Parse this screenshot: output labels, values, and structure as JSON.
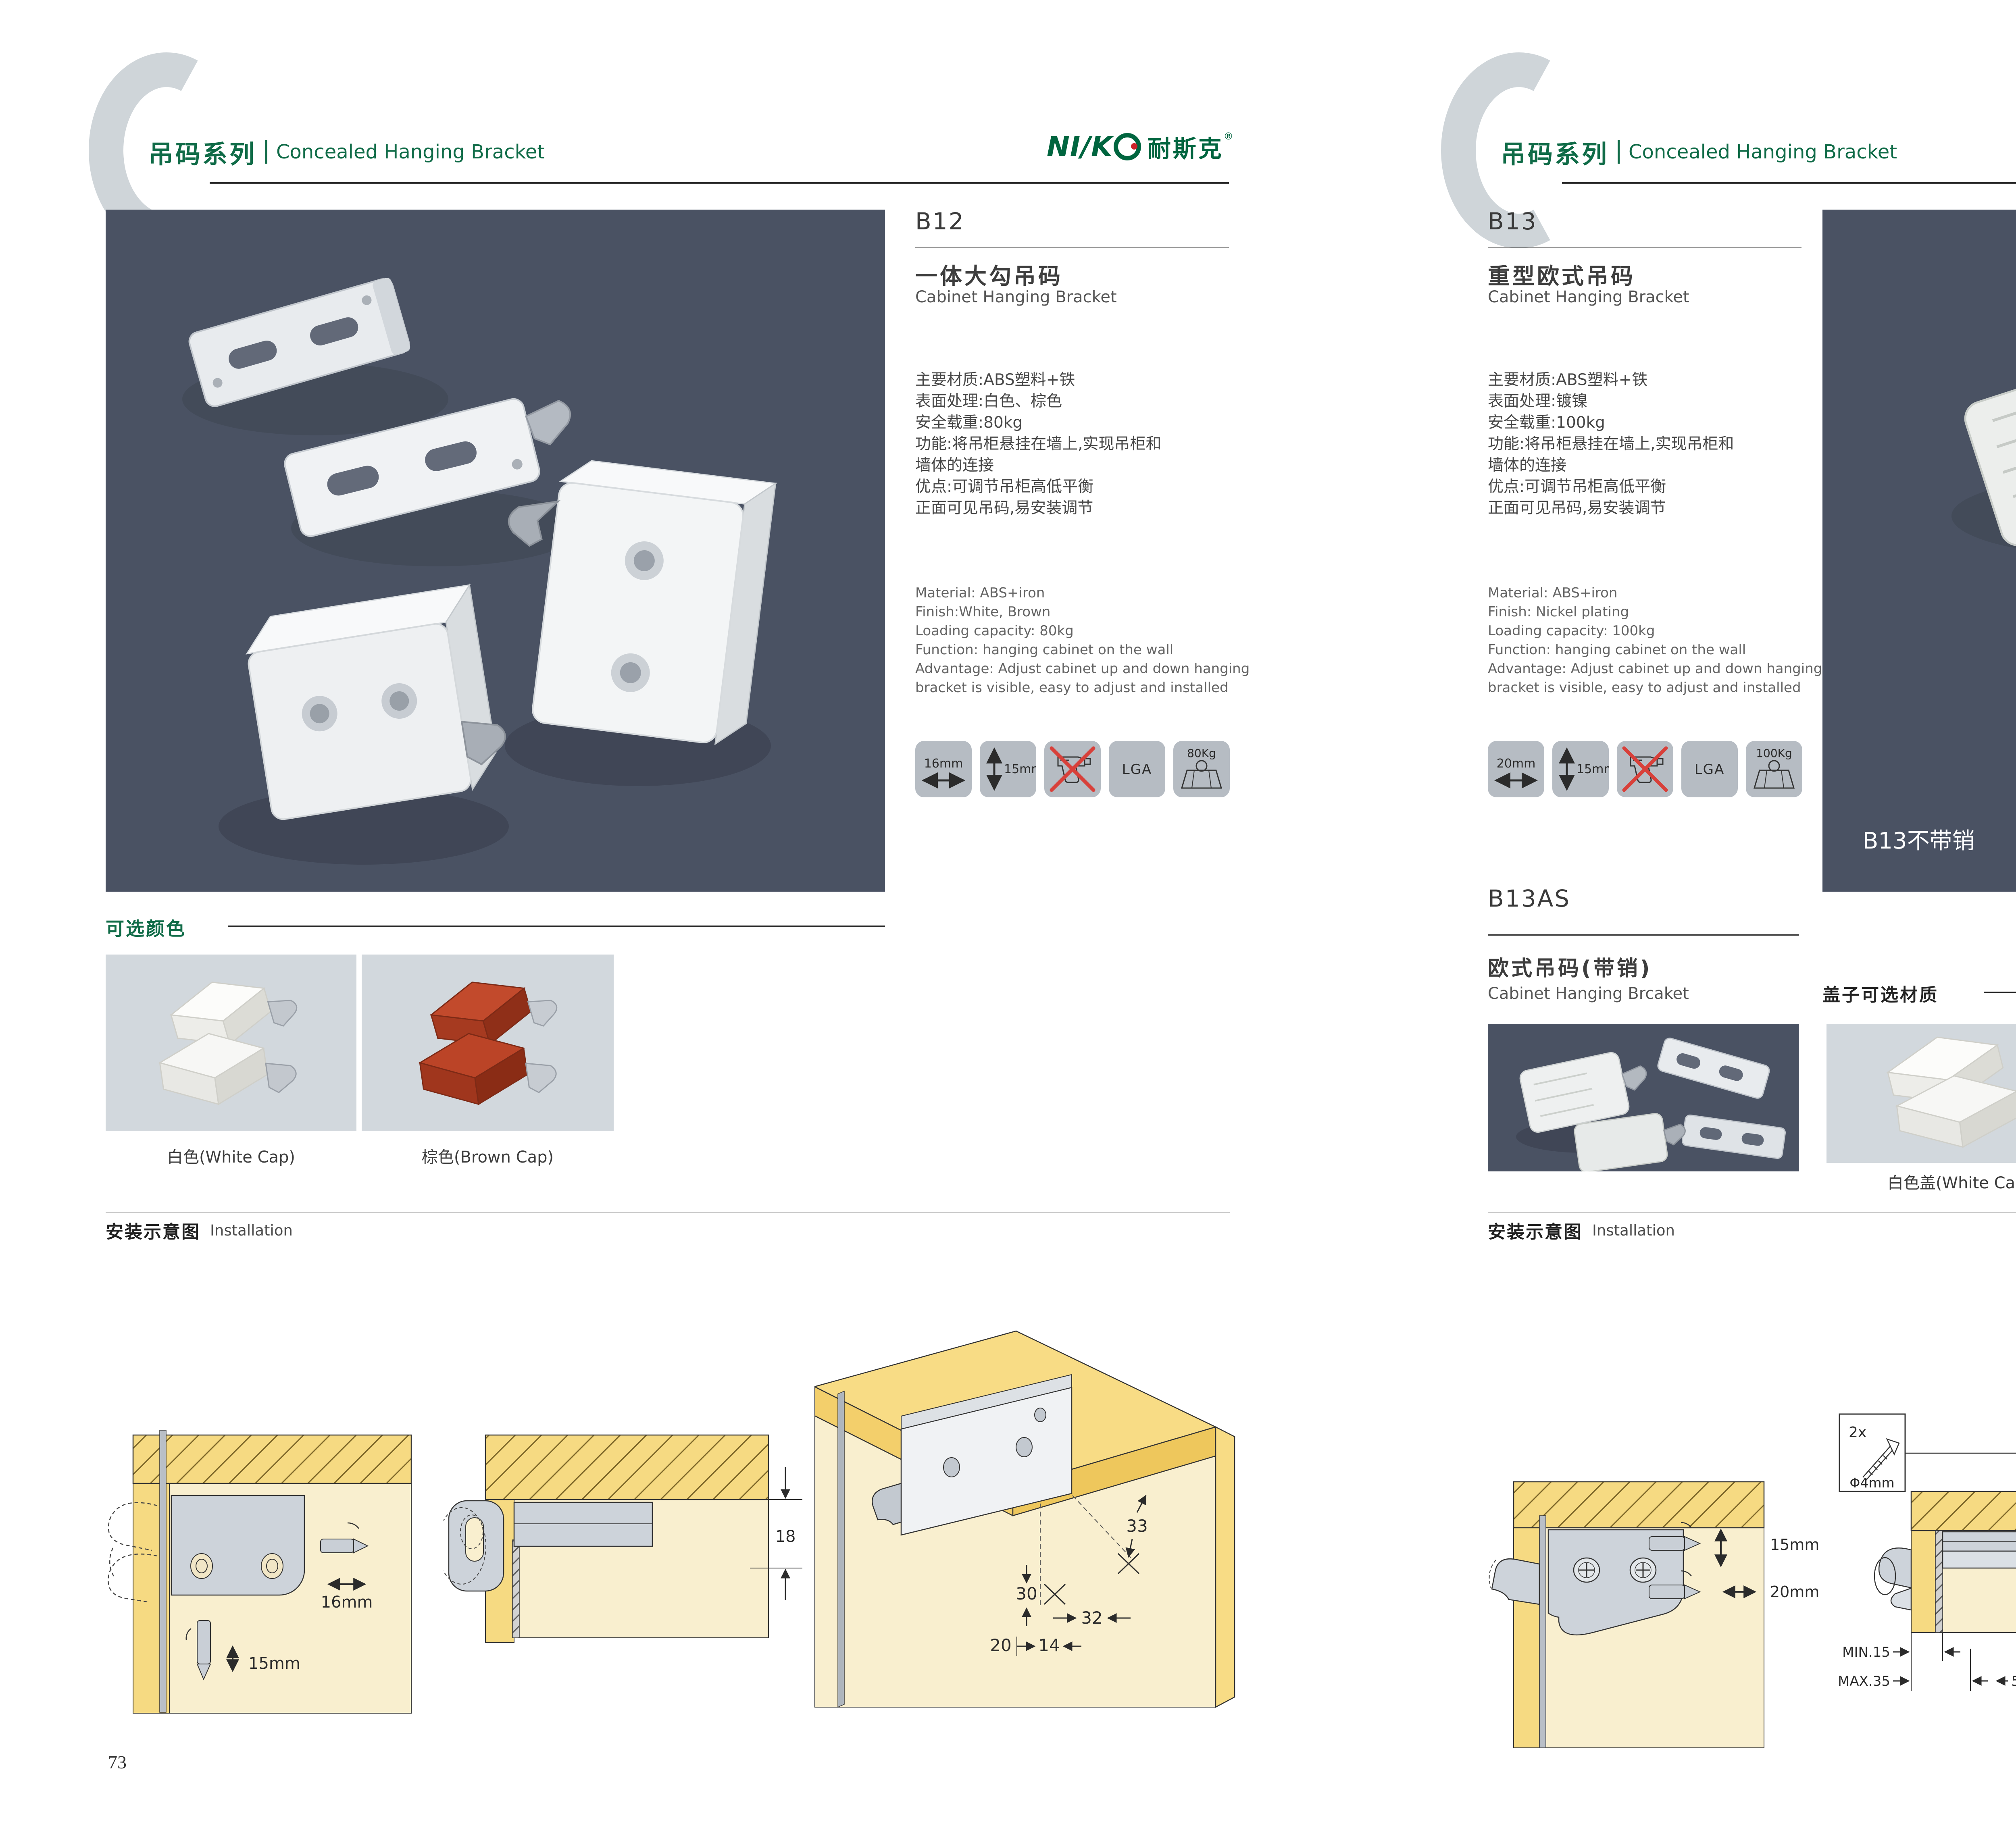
{
  "brand": {
    "logo_latin_1": "NI",
    "logo_slash": "∕",
    "logo_latin_2": "K",
    "logo_zh": "耐斯克",
    "reg": "®"
  },
  "header": {
    "series_zh": "吊码系列",
    "series_en": "Concealed Hanging Bracket"
  },
  "left": {
    "code": "B12",
    "title_zh": "一体大勾吊码",
    "title_en": "Cabinet Hanging Bracket",
    "specs_zh": [
      "主要材质:ABS塑料+铁",
      "表面处理:白色、棕色",
      "安全载重:80kg",
      "功能:将吊柜悬挂在墙上,实现吊柜和",
      "墙体的连接",
      "优点:可调节吊柜高低平衡",
      "正面可见吊码,易安装调节"
    ],
    "specs_en": [
      "Material: ABS+iron",
      "Finish:White, Brown",
      "Loading capacity: 80kg",
      "Function: hanging cabinet on the wall",
      "Advantage: Adjust cabinet up and down hanging",
      "bracket is visible, easy to adjust and installed"
    ],
    "icons": {
      "width": "16mm",
      "height": "15mm",
      "cert": "LGA",
      "weight": "80Kg"
    },
    "colors_title": "可选颜色",
    "color_white": "白色(White Cap)",
    "color_brown": "棕色(Brown Cap)",
    "install_zh": "安装示意图",
    "install_en": "Installation",
    "d1": {
      "width": "16mm",
      "depth": "15mm"
    },
    "d2": {
      "t": "18"
    },
    "d3": {
      "a": "33",
      "b": "30",
      "c": "32",
      "d": "20",
      "e": "14"
    },
    "page": "73"
  },
  "right": {
    "code": "B13",
    "title_zh": "重型欧式吊码",
    "title_en": "Cabinet Hanging Bracket",
    "specs_zh": [
      "主要材质:ABS塑料+铁",
      "表面处理:镀镍",
      "安全载重:100kg",
      "功能:将吊柜悬挂在墙上,实现吊柜和",
      "墙体的连接",
      "优点:可调节吊柜高低平衡",
      "正面可见吊码,易安装调节"
    ],
    "specs_en": [
      "Material: ABS+iron",
      "Finish: Nickel plating",
      "Loading capacity: 100kg",
      "Function: hanging cabinet on the wall",
      "Advantage: Adjust cabinet up and down hanging",
      "bracket is visible, easy to adjust and installed"
    ],
    "icons": {
      "width": "20mm",
      "height": "15mm",
      "cert": "LGA",
      "weight": "100Kg"
    },
    "photo_caption": "B13不带销",
    "variant_code": "B13AS",
    "variant_zh": "欧式吊码(带销)",
    "variant_en": "Cabinet Hanging Brcaket",
    "caps_title": "盖子可选材质",
    "cap_white": "白色盖(White Cap)",
    "cap_gray": "灰色盖(Gray Cap)",
    "install_zh": "安装示意图",
    "install_en": "Installation",
    "screw": {
      "count": "2x",
      "dia": "Φ4mm"
    },
    "d4": {
      "depth": "15mm",
      "width": "20mm"
    },
    "d5": {
      "t": "18",
      "min": "MIN.15",
      "max": "MAX.35",
      "off": "58"
    },
    "d6": {
      "a": "16",
      "b": "40",
      "r": "RMAX4",
      "c": "19",
      "d": "18",
      "e": "32"
    },
    "page": "74"
  },
  "colors": {
    "accent_green": "#0f6b47",
    "logo_green": "#00653f",
    "logo_red": "#cc2229",
    "photo_bg": "#4a5263",
    "light_photo_bg": "#d2d8dd",
    "wood_yellow": "#f6da82",
    "panel_cream": "#f9efcf",
    "icon_bg": "#b6bcc3",
    "cross_red": "#d8403a"
  }
}
